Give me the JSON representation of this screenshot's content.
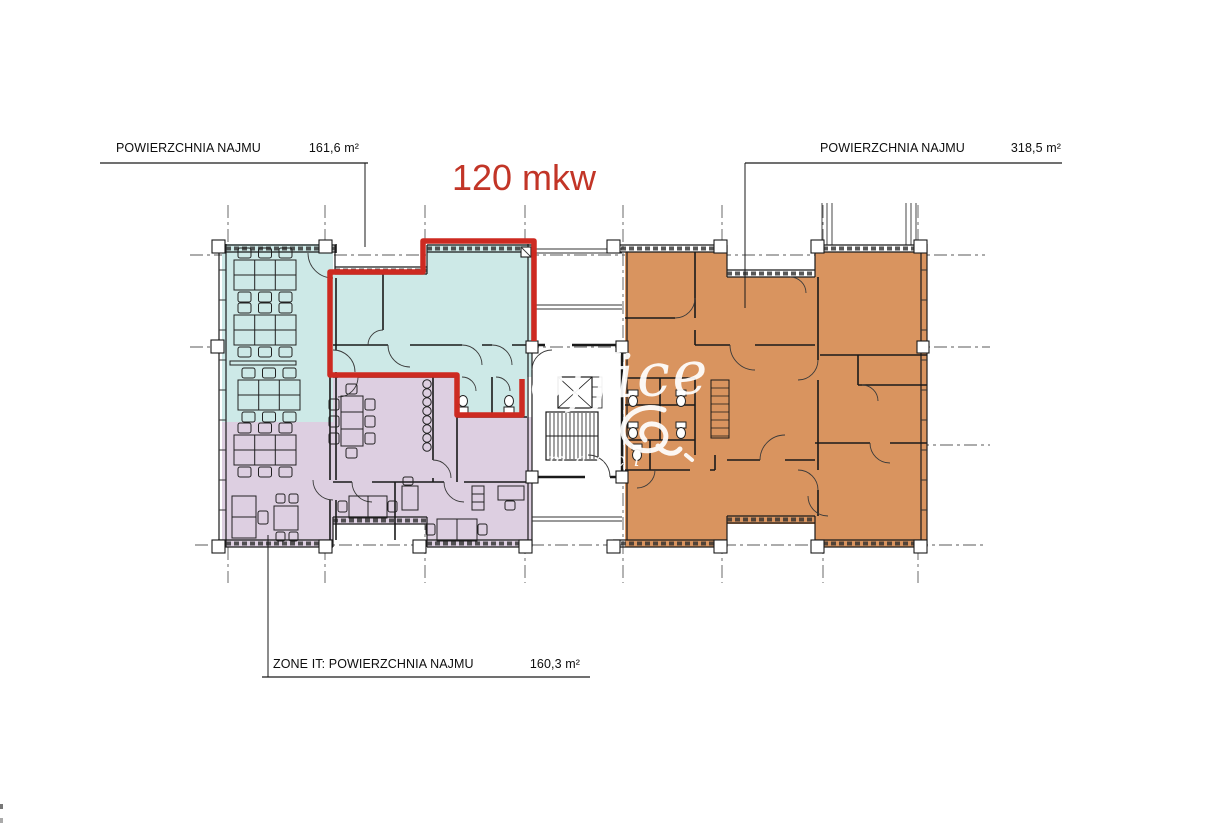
{
  "colors": {
    "teal": "#cde9e7",
    "purple": "#ddcfe1",
    "orange": "#d9945f",
    "red": "#cd2a21",
    "red-text": "#c23527"
  },
  "annotations": {
    "top_left": {
      "label": "POWIERZCHNIA NAJMU",
      "value": "161,6 m²"
    },
    "top_right": {
      "label": "POWIERZCHNIA NAJMU",
      "value": "318,5 m²"
    },
    "bottom": {
      "label": "ZONE IT: POWIERZCHNIA NAJMU",
      "value": "160,3 m²"
    },
    "highlight": {
      "text": "120 mkw"
    }
  },
  "watermark": {
    "text": "office",
    "tagline": "masci"
  }
}
